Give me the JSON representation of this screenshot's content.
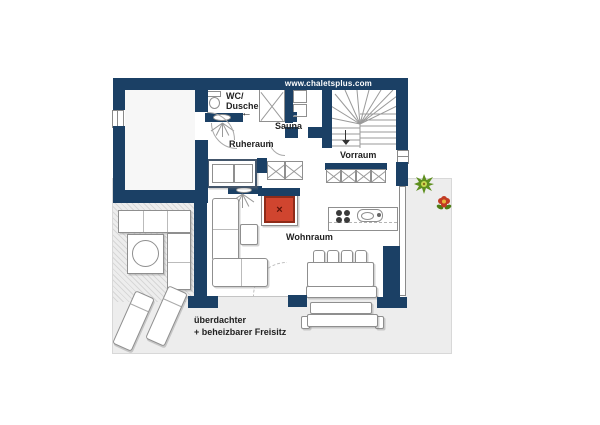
{
  "header": {
    "url_label": "www.chaletsplus.com"
  },
  "labels": {
    "wc_line1": "WC/",
    "wc_line2": "Dusche",
    "sauna": "Sauna",
    "ruheraum": "Ruheraum",
    "vorraum": "Vorraum",
    "wohnraum": "Wohnraum",
    "freisitz_line1": "überdachter",
    "freisitz_line2": "+ beheizbarer Freisitz"
  },
  "glyphs": {
    "entry_arrow": "←",
    "stove_x": "×"
  },
  "colors": {
    "wall": "#1b4065",
    "stove_red": "#d0452f",
    "stove_red_border": "#8f2b19",
    "terrace_gray": "#ededed",
    "plant_green": "#5e8f1e",
    "plant_green_light": "#c8d850",
    "flower_red": "#c23b24",
    "flower_center": "#e9b63a",
    "furniture_line": "#8f8f8f"
  }
}
